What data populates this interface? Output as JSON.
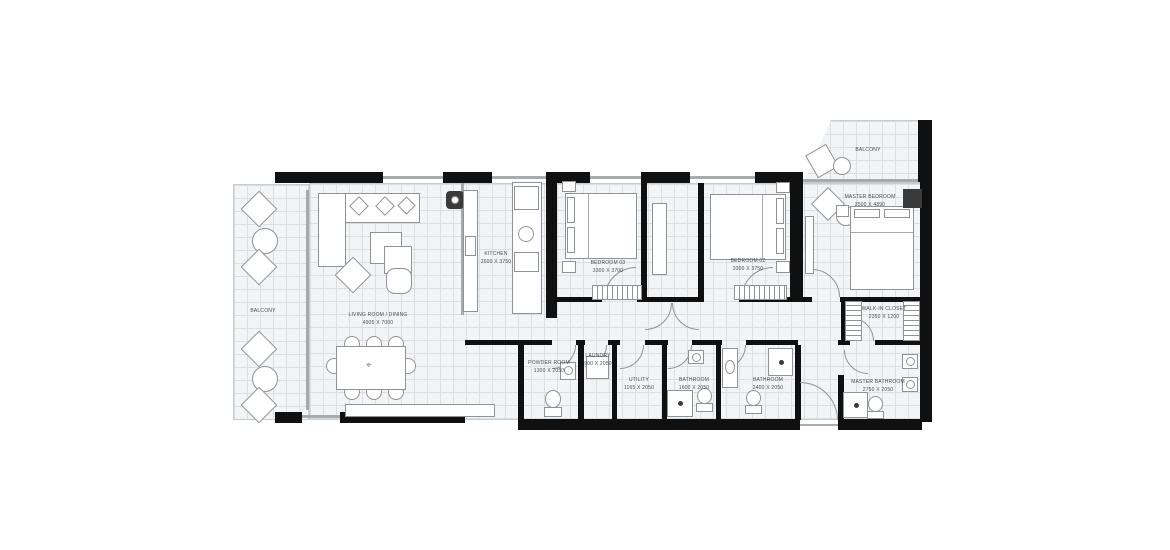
{
  "colors": {
    "wall": "#101010",
    "line": "#8f9296",
    "floor": "#f3f4f5",
    "grid": "#dcdfe1",
    "text": "#4a4d50",
    "dark": "#3a3a3a"
  },
  "icons": {
    "compass": "⌖"
  },
  "rooms": [
    {
      "name": "BALCONY",
      "dims": ""
    },
    {
      "name": "LIVING ROOM / DINING",
      "dims": "4905 X 7000"
    },
    {
      "name": "KITCHEN",
      "dims": "2600 X 3750"
    },
    {
      "name": "BEDROOM 03",
      "dims": "3300 X 3700"
    },
    {
      "name": "BEDROOM 02",
      "dims": "3300 X 3750"
    },
    {
      "name": "MASTER BEDROOM",
      "dims": "3500 X 4890"
    },
    {
      "name": "BALCONY",
      "dims": ""
    },
    {
      "name": "WALK-IN CLOSET",
      "dims": "2350 X 1200"
    },
    {
      "name": "POWDER ROOM",
      "dims": "1300 X 2050"
    },
    {
      "name": "LAUNDRY",
      "dims": "900 X 2050"
    },
    {
      "name": "UTILITY",
      "dims": "1165 X 2050"
    },
    {
      "name": "BATHROOM",
      "dims": "1600 X 2050"
    },
    {
      "name": "BATHROOM",
      "dims": "2400 X 2050"
    },
    {
      "name": "MASTER BATHROOM",
      "dims": "2750 X 2050"
    }
  ]
}
